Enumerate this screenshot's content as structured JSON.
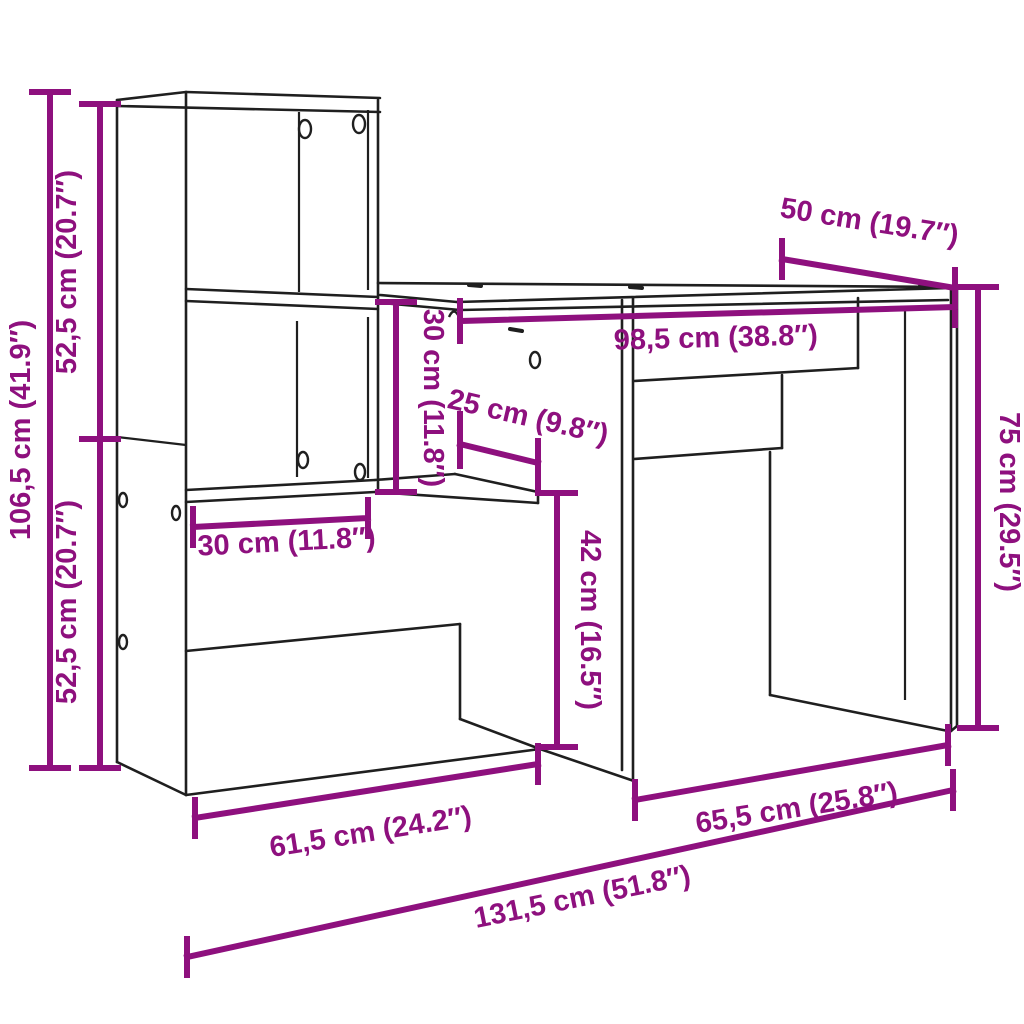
{
  "diagram": {
    "title": "Desk with shelf unit dimension diagram",
    "accent_color": "#8E107E",
    "outline_color": "#1f1f1f",
    "background_color": "#ffffff",
    "dimensions": {
      "total_height": "106,5 cm (41.9″)",
      "upper_section_height": "52,5 cm (20.7″)",
      "lower_section_height": "52,5 cm (20.7″)",
      "desk_depth": "50 cm (19.7″)",
      "desktop_width": "98,5 cm (38.8″)",
      "shelf_opening_height": "30 cm (11.8″)",
      "shelf_depth": "25 cm (9.8″)",
      "shelf_width": "30 cm (11.8″)",
      "under_shelf_clearance": "42 cm (16.5″)",
      "desk_height": "75 cm (29.5″)",
      "shelf_unit_width": "61,5 cm (24.2″)",
      "desk_section_width": "65,5 cm (25.8″)",
      "total_width": "131,5 cm (51.8″)"
    }
  }
}
